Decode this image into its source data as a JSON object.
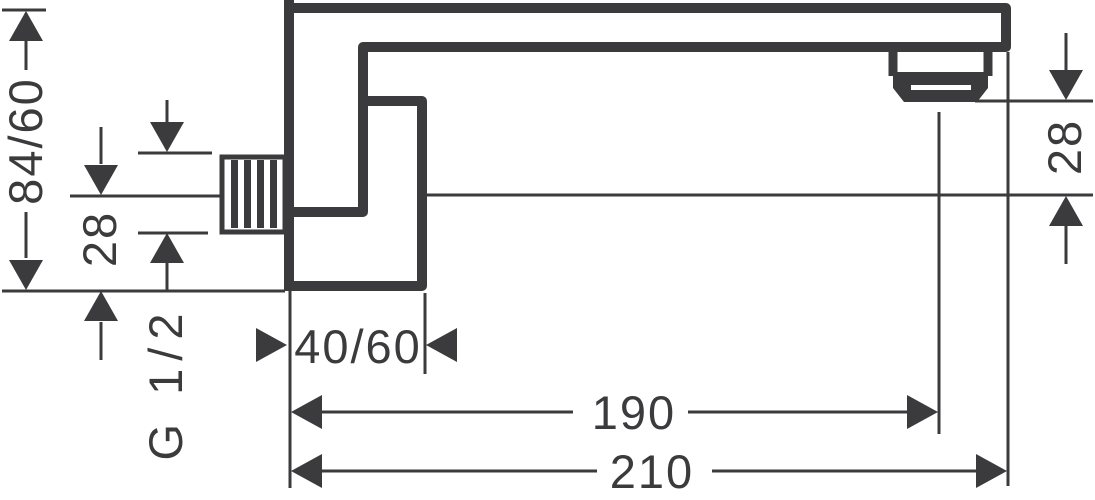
{
  "drawing": {
    "background_color": "#ffffff",
    "line_color": "#3b3b3d",
    "dim_labels": {
      "overall_height": "84/60",
      "axis_to_plate_bottom": "28",
      "thread": "G 1/2",
      "plate_projection": "40/60",
      "length_to_aerator": "190",
      "length_overall": "210",
      "aerator_to_axis": "28"
    }
  }
}
